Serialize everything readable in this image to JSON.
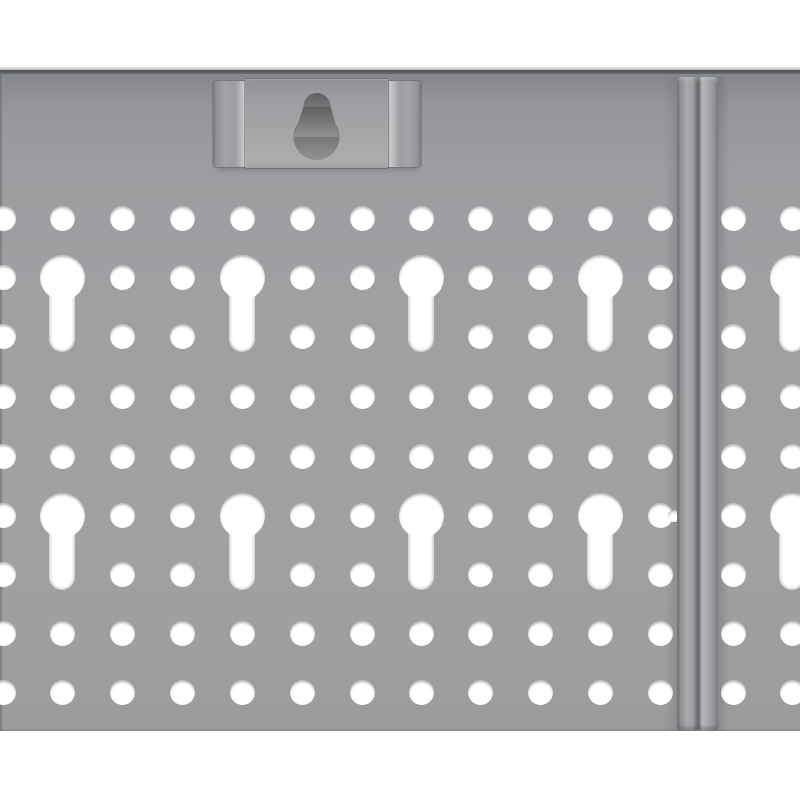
{
  "scene": {
    "subject": "close-up of a gray metal pegboard tool-wall panel",
    "description": "Perforated gray steel pegboard with rows of round holes and vertical keyhole slots, a wall-mount bracket tab with an inverted keyhole at top center-left, and a double vertical joining seam near the right edge separating a second identical panel; white background above and below the panel.",
    "background_color": "#ffffff",
    "panel": {
      "base_color": "#9da0a2",
      "top_edge_highlight_color": "#ecedee",
      "top_edge_shadow_color": "#54575a",
      "hole_color": "#ffffff",
      "top_y": 67,
      "bottom_y": 731
    },
    "grid": {
      "hole_radius": 12.5,
      "rows_y": [
        218,
        277,
        336,
        396,
        456,
        515,
        574,
        633,
        692
      ],
      "left_panel_columns_x": [
        3,
        62,
        122,
        182,
        242,
        302,
        362,
        421,
        480,
        540,
        600,
        660
      ],
      "right_panel_columns_x": [
        733,
        792
      ],
      "keyhole_columns_x": [
        62,
        242,
        421,
        600,
        792
      ],
      "keyhole_rows_y": [
        277,
        515
      ],
      "keyhole_occupied_row_indexes": [
        1,
        2,
        5,
        6
      ],
      "keyhole_circle_radius": 22.5,
      "keyhole_slot_half_width": 13,
      "keyhole_slot_length": 75,
      "partial_hole_at_seam": {
        "x": 674,
        "y": 516,
        "radius": 6
      }
    },
    "seam": {
      "left_strip_x": 677,
      "right_strip_x": 698,
      "strip_width": 20,
      "top_y": 77,
      "bottom_y": 731,
      "highlight_color": "#b5b7b9",
      "shadow_color": "#55575a"
    },
    "bracket": {
      "left_x": 213,
      "right_x": 421,
      "top_y": 79,
      "bottom_y": 168,
      "plate_color": "#a3a5a7",
      "flange_highlight_color": "#c8cacb",
      "keyhole_small_circle": {
        "cx": 317,
        "cy": 106.5,
        "r": 13.5
      },
      "keyhole_large_circle": {
        "cx": 316.5,
        "cy": 137,
        "r": 23
      },
      "keyhole_fill_top": "#5d5f61",
      "keyhole_fill_bottom": "#8f9193"
    }
  }
}
